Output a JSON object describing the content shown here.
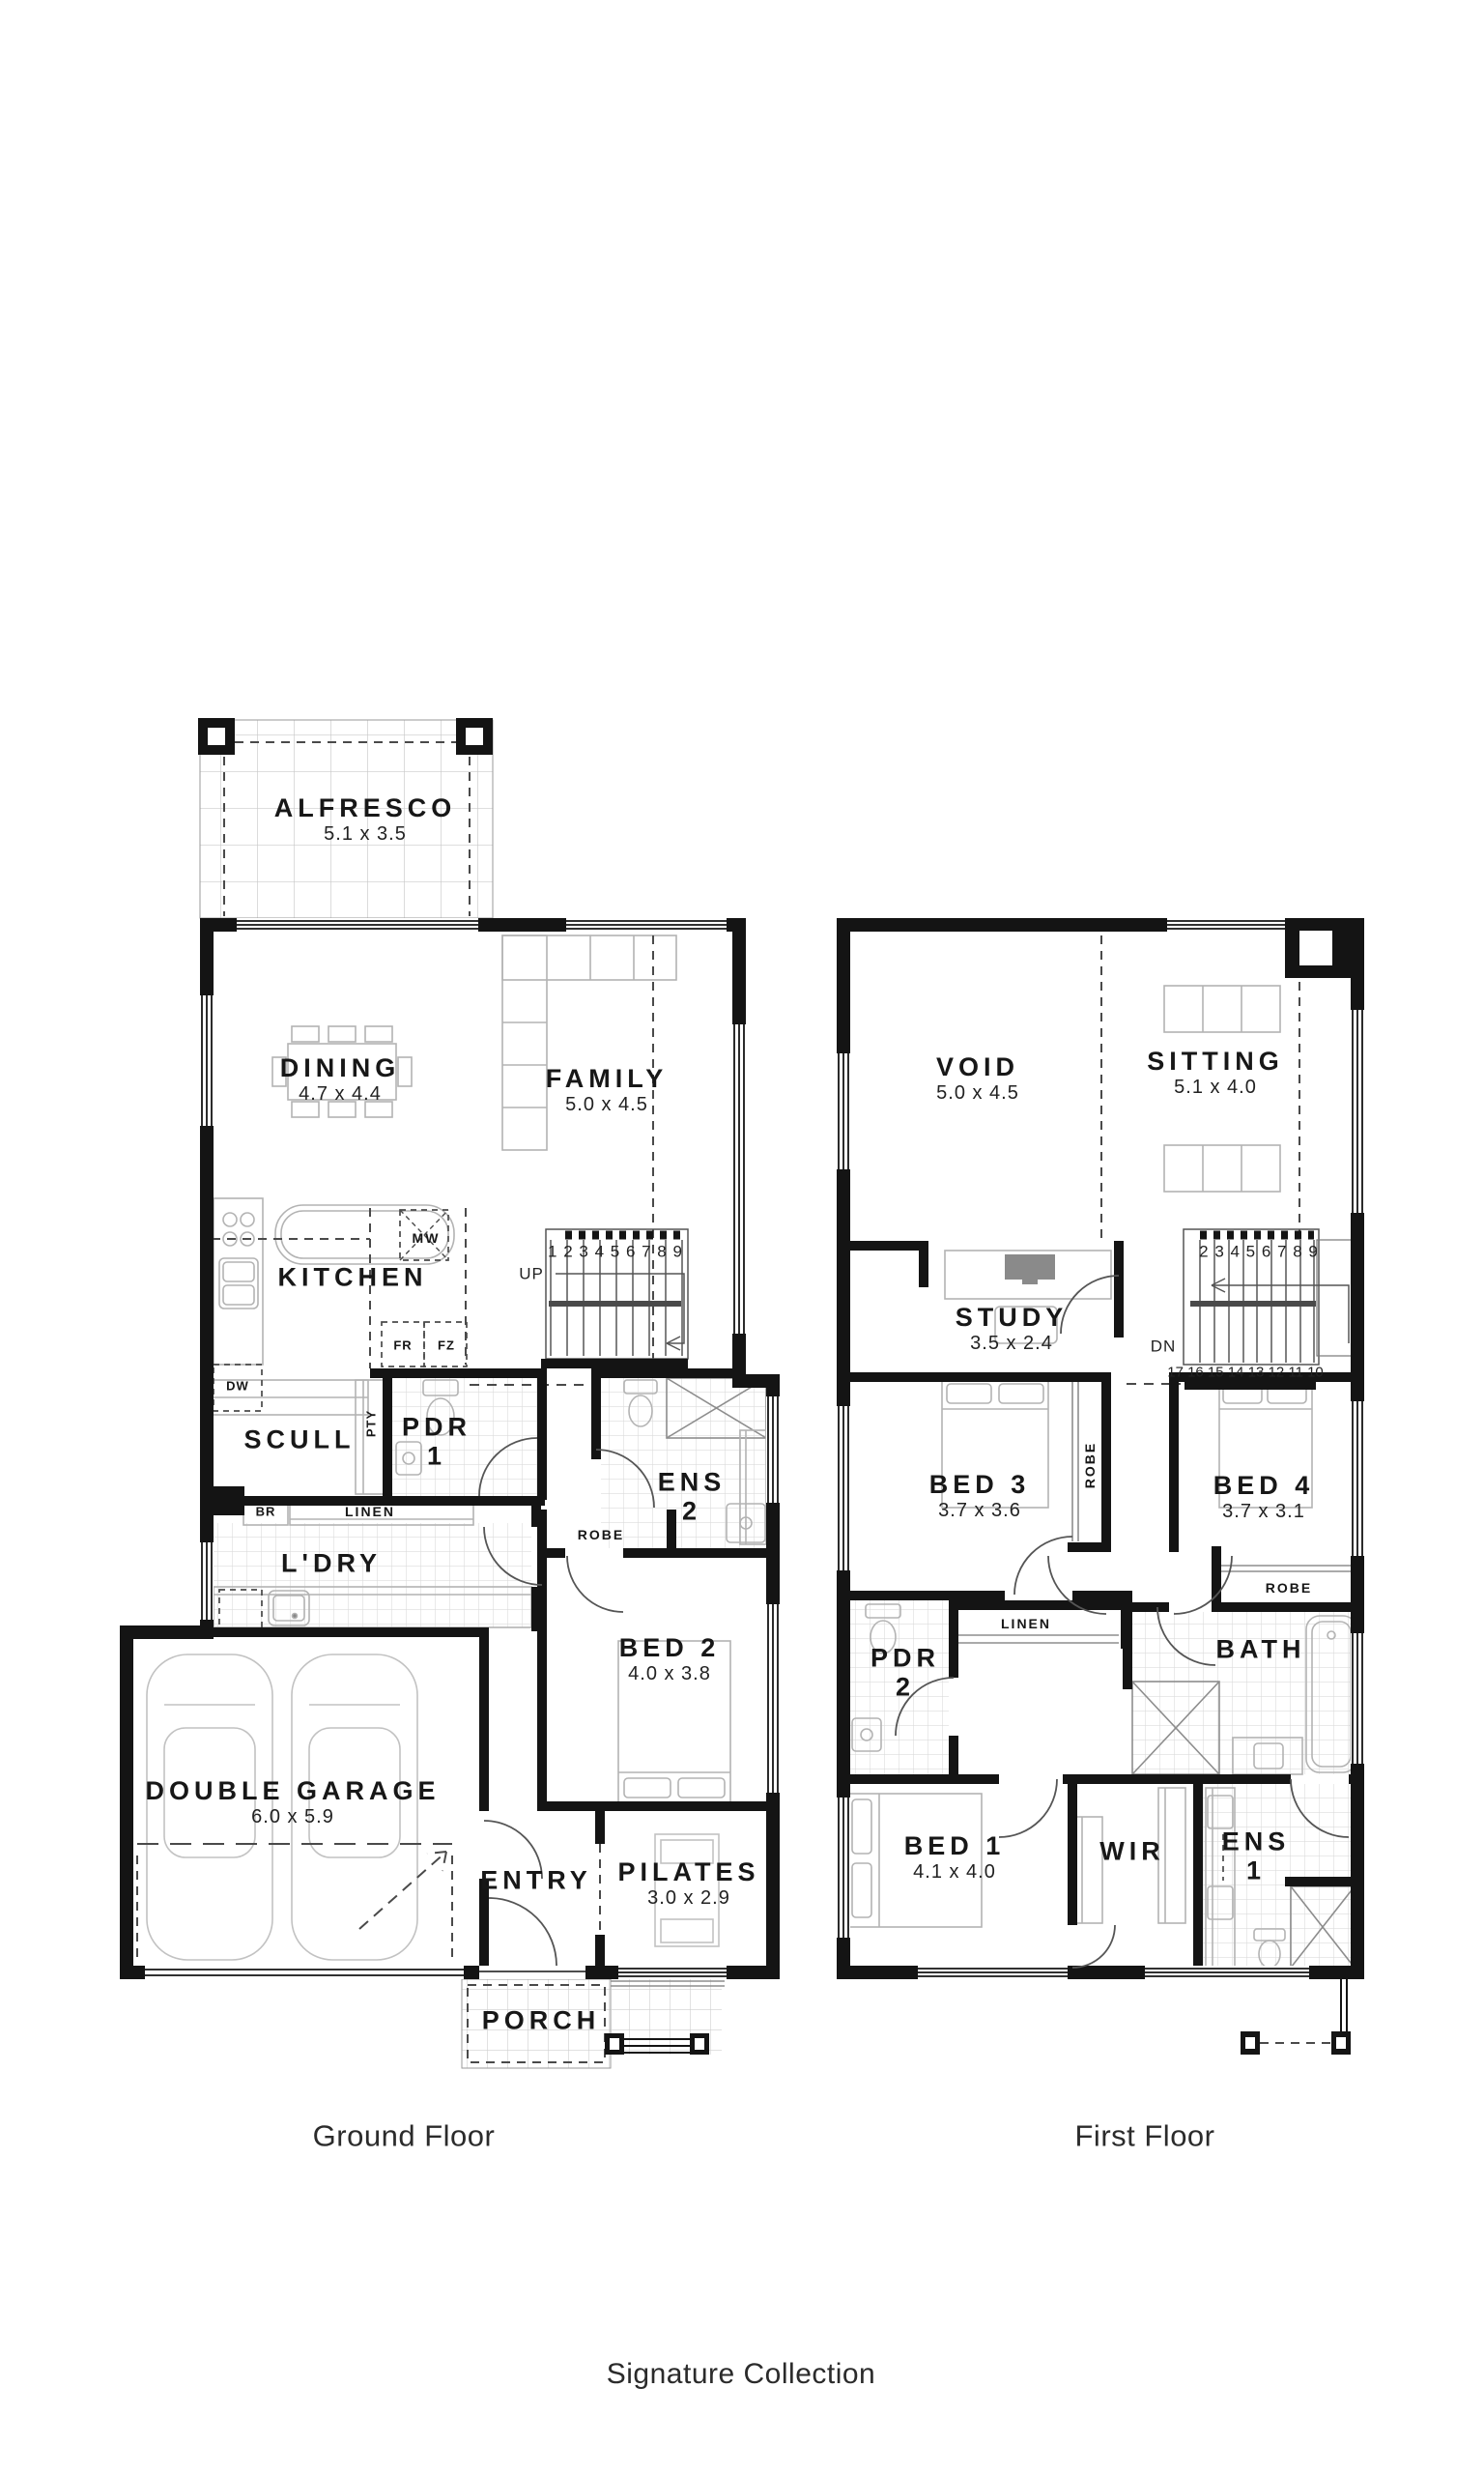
{
  "brand": {
    "collection_label": "Signature Collection"
  },
  "ground_floor": {
    "floor_label": "Ground Floor",
    "rooms": {
      "alfresco": {
        "name": "ALFRESCO",
        "dims": "5.1 x 3.5"
      },
      "dining": {
        "name": "DINING",
        "dims": "4.7 x 4.4"
      },
      "family": {
        "name": "FAMILY",
        "dims": "5.0 x 4.5"
      },
      "kitchen": {
        "name": "KITCHEN"
      },
      "scull": {
        "name": "SCULL"
      },
      "pdr_1": {
        "name": "PDR",
        "number": "1"
      },
      "ens_2": {
        "name": "ENS",
        "number": "2"
      },
      "laundry": {
        "name": "L'DRY"
      },
      "bed_2": {
        "name": "BED 2",
        "dims": "4.0 x 3.8"
      },
      "double_garage": {
        "name": "DOUBLE GARAGE",
        "dims": "6.0 x 5.9"
      },
      "entry": {
        "name": "ENTRY"
      },
      "pilates": {
        "name": "PILATES",
        "dims": "3.0 x 2.9"
      },
      "porch": {
        "name": "PORCH"
      }
    },
    "fixtures": {
      "microwave": "MW",
      "fridge": "FR",
      "freezer": "FZ",
      "dishwasher": "DW",
      "broom": "BR",
      "linen": "LINEN",
      "pantry": "PTY",
      "robe": "ROBE"
    },
    "stairs": {
      "direction": "UP",
      "treads": "1 2 3 4 5 6 7 8 9"
    }
  },
  "first_floor": {
    "floor_label": "First Floor",
    "rooms": {
      "void": {
        "name": "VOID",
        "dims": "5.0 x 4.5"
      },
      "sitting": {
        "name": "SITTING",
        "dims": "5.1 x 4.0"
      },
      "study": {
        "name": "STUDY",
        "dims": "3.5 x 2.4"
      },
      "bed_3": {
        "name": "BED 3",
        "dims": "3.7 x 3.6"
      },
      "bed_4": {
        "name": "BED 4",
        "dims": "3.7 x 3.1"
      },
      "pdr_2": {
        "name": "PDR",
        "number": "2"
      },
      "bath": {
        "name": "BATH"
      },
      "bed_1": {
        "name": "BED 1",
        "dims": "4.1 x 4.0"
      },
      "wir": {
        "name": "WIR"
      },
      "ens_1": {
        "name": "ENS",
        "number": "1"
      }
    },
    "fixtures": {
      "linen": "LINEN",
      "robe_bed3": "ROBE",
      "robe_bed4": "ROBE"
    },
    "stairs": {
      "direction": "DN",
      "treads_upper": "2 3 4 5 6 7 8 9",
      "treads_lower": "17 16 15 14 13 12 11 10"
    }
  }
}
